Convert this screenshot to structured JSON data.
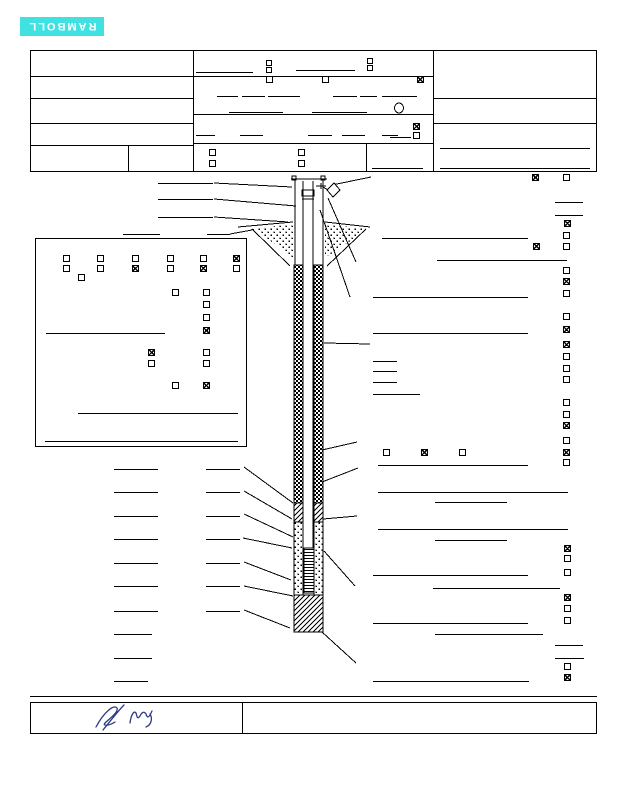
{
  "page": {
    "width": 618,
    "height": 800,
    "bg": "#ffffff",
    "ink": "#000000"
  },
  "logo": {
    "label": "RAMBOLL",
    "bg": "#3fe1e1",
    "fg": "#ffffff",
    "x": 20,
    "y": 17,
    "w": 84,
    "h": 19,
    "note": "logo printed rotated 180 degrees"
  },
  "signature": {
    "color": "#2b3c82",
    "paths": [
      "M96,727 C104,712 114,704 117,708 C119,712 109,719 105,723 C102,726 109,726 115,722 M103,730 C111,720 119,710 124,705",
      "M130,723 C131,715 134,710 136,713 C137,716 137,720 140,716 C142,712 144,711 146,714 C147,717 148,720 152,711 M150,714 C153,719 151,725 146,727"
    ]
  },
  "boxes": [
    {
      "name": "header-outer-box",
      "x": 30,
      "y": 50,
      "w": 567,
      "h": 122
    },
    {
      "name": "construction-details-panel",
      "x": 35,
      "y": 238,
      "w": 212,
      "h": 209
    },
    {
      "name": "signature-box",
      "x": 30,
      "y": 702,
      "w": 567,
      "h": 32
    }
  ],
  "vlines": [
    {
      "name": "header-divider-left",
      "x": 193,
      "y1": 50,
      "y2": 172
    },
    {
      "name": "header-divider-right",
      "x": 433,
      "y1": 50,
      "y2": 172
    },
    {
      "name": "header-left-sub-divider",
      "x": 128,
      "y1": 145,
      "y2": 171
    },
    {
      "name": "header-mid-sub-divider",
      "x": 366,
      "y1": 143,
      "y2": 172
    },
    {
      "name": "signature-divider",
      "x": 242,
      "y1": 702,
      "y2": 734
    }
  ],
  "hlines": [
    {
      "x": 30,
      "y": 76,
      "w": 163
    },
    {
      "x": 30,
      "y": 98,
      "w": 163
    },
    {
      "x": 30,
      "y": 123,
      "w": 163
    },
    {
      "x": 30,
      "y": 145,
      "w": 163
    },
    {
      "x": 193,
      "y": 76,
      "w": 240
    },
    {
      "x": 193,
      "y": 114,
      "w": 240
    },
    {
      "x": 193,
      "y": 143,
      "w": 240
    },
    {
      "x": 433,
      "y": 98,
      "w": 164
    },
    {
      "x": 433,
      "y": 123,
      "w": 164
    },
    {
      "x": 196,
      "y": 72,
      "w": 57
    },
    {
      "x": 296,
      "y": 70,
      "w": 59
    },
    {
      "x": 217,
      "y": 96,
      "w": 21
    },
    {
      "x": 242,
      "y": 96,
      "w": 23
    },
    {
      "x": 268,
      "y": 96,
      "w": 32
    },
    {
      "x": 333,
      "y": 96,
      "w": 24
    },
    {
      "x": 360,
      "y": 96,
      "w": 17
    },
    {
      "x": 382,
      "y": 96,
      "w": 35
    },
    {
      "x": 229,
      "y": 112,
      "w": 54
    },
    {
      "x": 312,
      "y": 112,
      "w": 55
    },
    {
      "x": 196,
      "y": 135,
      "w": 19
    },
    {
      "x": 240,
      "y": 135,
      "w": 23
    },
    {
      "x": 308,
      "y": 135,
      "w": 24
    },
    {
      "x": 342,
      "y": 135,
      "w": 23
    },
    {
      "x": 382,
      "y": 135,
      "w": 16
    },
    {
      "x": 390,
      "y": 137,
      "w": 21
    },
    {
      "x": 372,
      "y": 168,
      "w": 51
    },
    {
      "x": 440,
      "y": 148,
      "w": 150
    },
    {
      "x": 440,
      "y": 168,
      "w": 150
    },
    {
      "x": 555,
      "y": 202,
      "w": 28
    },
    {
      "x": 555,
      "y": 215,
      "w": 28
    },
    {
      "x": 382,
      "y": 238,
      "w": 146
    },
    {
      "x": 437,
      "y": 260,
      "w": 130
    },
    {
      "x": 373,
      "y": 297,
      "w": 155
    },
    {
      "x": 373,
      "y": 333,
      "w": 155
    },
    {
      "x": 373,
      "y": 361,
      "w": 24
    },
    {
      "x": 373,
      "y": 371,
      "w": 24
    },
    {
      "x": 373,
      "y": 382,
      "w": 24
    },
    {
      "x": 373,
      "y": 394,
      "w": 47
    },
    {
      "x": 378,
      "y": 465,
      "w": 150
    },
    {
      "x": 378,
      "y": 492,
      "w": 190
    },
    {
      "x": 435,
      "y": 502,
      "w": 72
    },
    {
      "x": 378,
      "y": 529,
      "w": 190
    },
    {
      "x": 435,
      "y": 540,
      "w": 72
    },
    {
      "x": 373,
      "y": 575,
      "w": 155
    },
    {
      "x": 433,
      "y": 588,
      "w": 127
    },
    {
      "x": 373,
      "y": 623,
      "w": 155
    },
    {
      "x": 435,
      "y": 634,
      "w": 108
    },
    {
      "x": 555,
      "y": 645,
      "w": 28
    },
    {
      "x": 555,
      "y": 658,
      "w": 29
    },
    {
      "x": 373,
      "y": 681,
      "w": 156
    },
    {
      "x": 158,
      "y": 183,
      "w": 55
    },
    {
      "x": 158,
      "y": 199,
      "w": 55
    },
    {
      "x": 158,
      "y": 217,
      "w": 55
    },
    {
      "x": 123,
      "y": 234,
      "w": 37
    },
    {
      "x": 207,
      "y": 234,
      "w": 23
    },
    {
      "x": 46,
      "y": 333,
      "w": 119
    },
    {
      "x": 78,
      "y": 413,
      "w": 160
    },
    {
      "x": 45,
      "y": 441,
      "w": 193
    },
    {
      "x": 114,
      "y": 469,
      "w": 44
    },
    {
      "x": 114,
      "y": 492,
      "w": 44
    },
    {
      "x": 114,
      "y": 516,
      "w": 44
    },
    {
      "x": 114,
      "y": 539,
      "w": 44
    },
    {
      "x": 114,
      "y": 563,
      "w": 44
    },
    {
      "x": 114,
      "y": 586,
      "w": 44
    },
    {
      "x": 114,
      "y": 611,
      "w": 44
    },
    {
      "x": 114,
      "y": 634,
      "w": 38
    },
    {
      "x": 114,
      "y": 658,
      "w": 38
    },
    {
      "x": 114,
      "y": 681,
      "w": 34
    },
    {
      "x": 206,
      "y": 469,
      "w": 34
    },
    {
      "x": 206,
      "y": 492,
      "w": 34
    },
    {
      "x": 206,
      "y": 516,
      "w": 34
    },
    {
      "x": 206,
      "y": 539,
      "w": 34
    },
    {
      "x": 206,
      "y": 563,
      "w": 34
    },
    {
      "x": 206,
      "y": 586,
      "w": 34
    },
    {
      "x": 206,
      "y": 611,
      "w": 34
    },
    {
      "x": 30,
      "y": 696,
      "w": 567
    }
  ],
  "checkboxes": [
    {
      "x": 266,
      "y": 60,
      "s": 6,
      "checked": false
    },
    {
      "x": 266,
      "y": 67,
      "s": 6,
      "checked": false
    },
    {
      "x": 367,
      "y": 58,
      "s": 6,
      "checked": false
    },
    {
      "x": 367,
      "y": 65,
      "s": 6,
      "checked": false
    },
    {
      "x": 266,
      "y": 76,
      "s": 7,
      "checked": false
    },
    {
      "x": 322,
      "y": 76,
      "s": 7,
      "checked": false
    },
    {
      "x": 417,
      "y": 76,
      "s": 7,
      "checked": true
    },
    {
      "x": 413,
      "y": 123,
      "s": 7,
      "checked": true
    },
    {
      "x": 413,
      "y": 132,
      "s": 7,
      "checked": false
    },
    {
      "x": 209,
      "y": 149,
      "s": 7,
      "checked": false
    },
    {
      "x": 298,
      "y": 149,
      "s": 7,
      "checked": false
    },
    {
      "x": 209,
      "y": 160,
      "s": 7,
      "checked": false
    },
    {
      "x": 298,
      "y": 160,
      "s": 7,
      "checked": false
    },
    {
      "x": 532,
      "y": 174,
      "s": 7,
      "checked": true
    },
    {
      "x": 563,
      "y": 174,
      "s": 7,
      "checked": false
    },
    {
      "x": 564,
      "y": 220,
      "s": 7,
      "checked": true
    },
    {
      "x": 563,
      "y": 232,
      "s": 7,
      "checked": false
    },
    {
      "x": 533,
      "y": 243,
      "s": 7,
      "checked": true
    },
    {
      "x": 563,
      "y": 243,
      "s": 7,
      "checked": false
    },
    {
      "x": 563,
      "y": 267,
      "s": 7,
      "checked": false
    },
    {
      "x": 563,
      "y": 278,
      "s": 7,
      "checked": true
    },
    {
      "x": 563,
      "y": 290,
      "s": 7,
      "checked": false
    },
    {
      "x": 563,
      "y": 313,
      "s": 7,
      "checked": false
    },
    {
      "x": 563,
      "y": 326,
      "s": 7,
      "checked": true
    },
    {
      "x": 563,
      "y": 341,
      "s": 7,
      "checked": true
    },
    {
      "x": 563,
      "y": 353,
      "s": 7,
      "checked": false
    },
    {
      "x": 563,
      "y": 365,
      "s": 7,
      "checked": false
    },
    {
      "x": 563,
      "y": 376,
      "s": 7,
      "checked": false
    },
    {
      "x": 563,
      "y": 399,
      "s": 7,
      "checked": false
    },
    {
      "x": 563,
      "y": 411,
      "s": 7,
      "checked": false
    },
    {
      "x": 563,
      "y": 422,
      "s": 7,
      "checked": true
    },
    {
      "x": 563,
      "y": 437,
      "s": 7,
      "checked": false
    },
    {
      "x": 383,
      "y": 449,
      "s": 7,
      "checked": false
    },
    {
      "x": 421,
      "y": 449,
      "s": 7,
      "checked": true
    },
    {
      "x": 459,
      "y": 449,
      "s": 7,
      "checked": false
    },
    {
      "x": 563,
      "y": 449,
      "s": 7,
      "checked": true
    },
    {
      "x": 563,
      "y": 459,
      "s": 7,
      "checked": false
    },
    {
      "x": 564,
      "y": 545,
      "s": 7,
      "checked": true
    },
    {
      "x": 564,
      "y": 555,
      "s": 7,
      "checked": false
    },
    {
      "x": 564,
      "y": 569,
      "s": 7,
      "checked": false
    },
    {
      "x": 564,
      "y": 594,
      "s": 7,
      "checked": true
    },
    {
      "x": 564,
      "y": 605,
      "s": 7,
      "checked": false
    },
    {
      "x": 564,
      "y": 617,
      "s": 7,
      "checked": false
    },
    {
      "x": 564,
      "y": 663,
      "s": 7,
      "checked": false
    },
    {
      "x": 564,
      "y": 674,
      "s": 7,
      "checked": true
    },
    {
      "x": 63,
      "y": 255,
      "s": 7,
      "checked": false
    },
    {
      "x": 97,
      "y": 255,
      "s": 7,
      "checked": false
    },
    {
      "x": 132,
      "y": 255,
      "s": 7,
      "checked": false
    },
    {
      "x": 167,
      "y": 255,
      "s": 7,
      "checked": false
    },
    {
      "x": 200,
      "y": 255,
      "s": 7,
      "checked": false
    },
    {
      "x": 233,
      "y": 255,
      "s": 7,
      "checked": true
    },
    {
      "x": 63,
      "y": 265,
      "s": 7,
      "checked": false
    },
    {
      "x": 97,
      "y": 265,
      "s": 7,
      "checked": false
    },
    {
      "x": 132,
      "y": 265,
      "s": 7,
      "checked": true
    },
    {
      "x": 167,
      "y": 265,
      "s": 7,
      "checked": false
    },
    {
      "x": 200,
      "y": 265,
      "s": 7,
      "checked": true
    },
    {
      "x": 233,
      "y": 265,
      "s": 7,
      "checked": false
    },
    {
      "x": 78,
      "y": 274,
      "s": 7,
      "checked": false
    },
    {
      "x": 172,
      "y": 289,
      "s": 7,
      "checked": false
    },
    {
      "x": 203,
      "y": 289,
      "s": 7,
      "checked": false
    },
    {
      "x": 203,
      "y": 301,
      "s": 7,
      "checked": false
    },
    {
      "x": 203,
      "y": 314,
      "s": 7,
      "checked": false
    },
    {
      "x": 203,
      "y": 327,
      "s": 7,
      "checked": true
    },
    {
      "x": 148,
      "y": 349,
      "s": 7,
      "checked": true
    },
    {
      "x": 203,
      "y": 349,
      "s": 7,
      "checked": false
    },
    {
      "x": 148,
      "y": 360,
      "s": 7,
      "checked": false
    },
    {
      "x": 203,
      "y": 360,
      "s": 7,
      "checked": false
    },
    {
      "x": 172,
      "y": 382,
      "s": 7,
      "checked": false
    },
    {
      "x": 203,
      "y": 382,
      "s": 7,
      "checked": true
    }
  ],
  "diagram": {
    "rects": [
      {
        "name": "grout-annulus-left",
        "x": 294,
        "y": 265,
        "w": 9,
        "h": 238,
        "fill": "checker"
      },
      {
        "name": "grout-annulus-right",
        "x": 314,
        "y": 265,
        "w": 9,
        "h": 238,
        "fill": "checker"
      },
      {
        "name": "bentonite-seal-left",
        "x": 294,
        "y": 503,
        "w": 9,
        "h": 19,
        "fill": "hatch"
      },
      {
        "name": "bentonite-seal-right",
        "x": 314,
        "y": 503,
        "w": 9,
        "h": 19,
        "fill": "hatch"
      },
      {
        "name": "sand-pack-left",
        "x": 294,
        "y": 522,
        "w": 9,
        "h": 73,
        "fill": "dots"
      },
      {
        "name": "sand-pack-right",
        "x": 314,
        "y": 522,
        "w": 9,
        "h": 73,
        "fill": "dots"
      },
      {
        "name": "well-screen",
        "x": 304,
        "y": 548,
        "w": 10,
        "h": 45,
        "fill": "screen"
      },
      {
        "name": "bottom-plug",
        "x": 294,
        "y": 595,
        "w": 29,
        "h": 37,
        "fill": "hatch"
      },
      {
        "name": "riser-cap",
        "x": 302,
        "y": 190,
        "w": 12,
        "h": 6,
        "fill": "none"
      },
      {
        "name": "casing-bolt-left",
        "x": 292,
        "y": 176,
        "w": 4,
        "h": 4,
        "fill": "none"
      },
      {
        "name": "casing-bolt-right",
        "x": 321,
        "y": 176,
        "w": 4,
        "h": 4,
        "fill": "none"
      }
    ],
    "polygons": [
      {
        "name": "backfill-stipple-left",
        "points": "252,229 293,224 293,258 264,236",
        "fill": "dots"
      },
      {
        "name": "backfill-stipple-right",
        "points": "325,224 366,229 352,240 325,258",
        "fill": "dots"
      }
    ],
    "lock": {
      "name": "padlock-icon",
      "points": "327,190 334,183 340,190 333,197"
    },
    "circle": {
      "name": "header-oval-mark",
      "cx": 399,
      "cy": 108,
      "rx": 4.5,
      "ry": 5
    },
    "lines": [
      {
        "x1": 295,
        "y1": 180,
        "x2": 295,
        "y2": 265,
        "name": "protective-casing-left"
      },
      {
        "x1": 323,
        "y1": 180,
        "x2": 323,
        "y2": 265,
        "name": "protective-casing-right"
      },
      {
        "x1": 291,
        "y1": 179,
        "x2": 327,
        "y2": 179,
        "name": "casing-top"
      },
      {
        "x1": 303,
        "y1": 181,
        "x2": 303,
        "y2": 548,
        "name": "riser-left"
      },
      {
        "x1": 313,
        "y1": 181,
        "x2": 313,
        "y2": 548,
        "name": "riser-right"
      },
      {
        "x1": 302,
        "y1": 196,
        "x2": 314,
        "y2": 196,
        "name": "riser-cap-line"
      },
      {
        "x1": 302,
        "y1": 199,
        "x2": 314,
        "y2": 199,
        "name": "riser-cap-line"
      },
      {
        "x1": 316,
        "y1": 186,
        "x2": 326,
        "y2": 186,
        "name": "hasp-bar"
      },
      {
        "x1": 321,
        "y1": 183,
        "x2": 321,
        "y2": 189,
        "name": "hasp-pin"
      },
      {
        "x1": 323,
        "y1": 187,
        "x2": 328,
        "y2": 190,
        "name": "lock-hasp"
      },
      {
        "x1": 238,
        "y1": 227,
        "x2": 293,
        "y2": 222,
        "name": "ground-line-left"
      },
      {
        "x1": 325,
        "y1": 222,
        "x2": 370,
        "y2": 227,
        "name": "ground-line-right"
      },
      {
        "x1": 252,
        "y1": 229,
        "x2": 290,
        "y2": 266,
        "name": "trench-line-left"
      },
      {
        "x1": 366,
        "y1": 229,
        "x2": 327,
        "y2": 266,
        "name": "trench-line-right"
      },
      {
        "x1": 214,
        "y1": 183,
        "x2": 292,
        "y2": 187,
        "name": "leader-line"
      },
      {
        "x1": 214,
        "y1": 199,
        "x2": 296,
        "y2": 206,
        "name": "leader-line"
      },
      {
        "x1": 214,
        "y1": 217,
        "x2": 288,
        "y2": 222,
        "name": "leader-line"
      },
      {
        "x1": 230,
        "y1": 234,
        "x2": 252,
        "y2": 230,
        "name": "leader-line"
      },
      {
        "x1": 332,
        "y1": 185,
        "x2": 371,
        "y2": 177,
        "name": "leader-line"
      },
      {
        "x1": 328,
        "y1": 198,
        "x2": 356,
        "y2": 262,
        "name": "leader-line"
      },
      {
        "x1": 320,
        "y1": 210,
        "x2": 350,
        "y2": 297,
        "name": "leader-line"
      },
      {
        "x1": 324,
        "y1": 343,
        "x2": 370,
        "y2": 344,
        "name": "leader-line"
      },
      {
        "x1": 322,
        "y1": 450,
        "x2": 357,
        "y2": 442,
        "name": "leader-line"
      },
      {
        "x1": 322,
        "y1": 482,
        "x2": 358,
        "y2": 468,
        "name": "leader-line"
      },
      {
        "x1": 323,
        "y1": 519,
        "x2": 357,
        "y2": 516,
        "name": "leader-line"
      },
      {
        "x1": 324,
        "y1": 551,
        "x2": 355,
        "y2": 586,
        "name": "leader-line"
      },
      {
        "x1": 322,
        "y1": 632,
        "x2": 356,
        "y2": 663,
        "name": "leader-line"
      },
      {
        "x1": 244,
        "y1": 467,
        "x2": 293,
        "y2": 503,
        "name": "leader-line"
      },
      {
        "x1": 244,
        "y1": 491,
        "x2": 292,
        "y2": 519,
        "name": "leader-line"
      },
      {
        "x1": 244,
        "y1": 514,
        "x2": 293,
        "y2": 537,
        "name": "leader-line"
      },
      {
        "x1": 243,
        "y1": 538,
        "x2": 292,
        "y2": 548,
        "name": "leader-line"
      },
      {
        "x1": 244,
        "y1": 562,
        "x2": 291,
        "y2": 580,
        "name": "leader-line"
      },
      {
        "x1": 244,
        "y1": 586,
        "x2": 293,
        "y2": 596,
        "name": "leader-line"
      },
      {
        "x1": 244,
        "y1": 610,
        "x2": 290,
        "y2": 628,
        "name": "leader-line"
      }
    ]
  }
}
